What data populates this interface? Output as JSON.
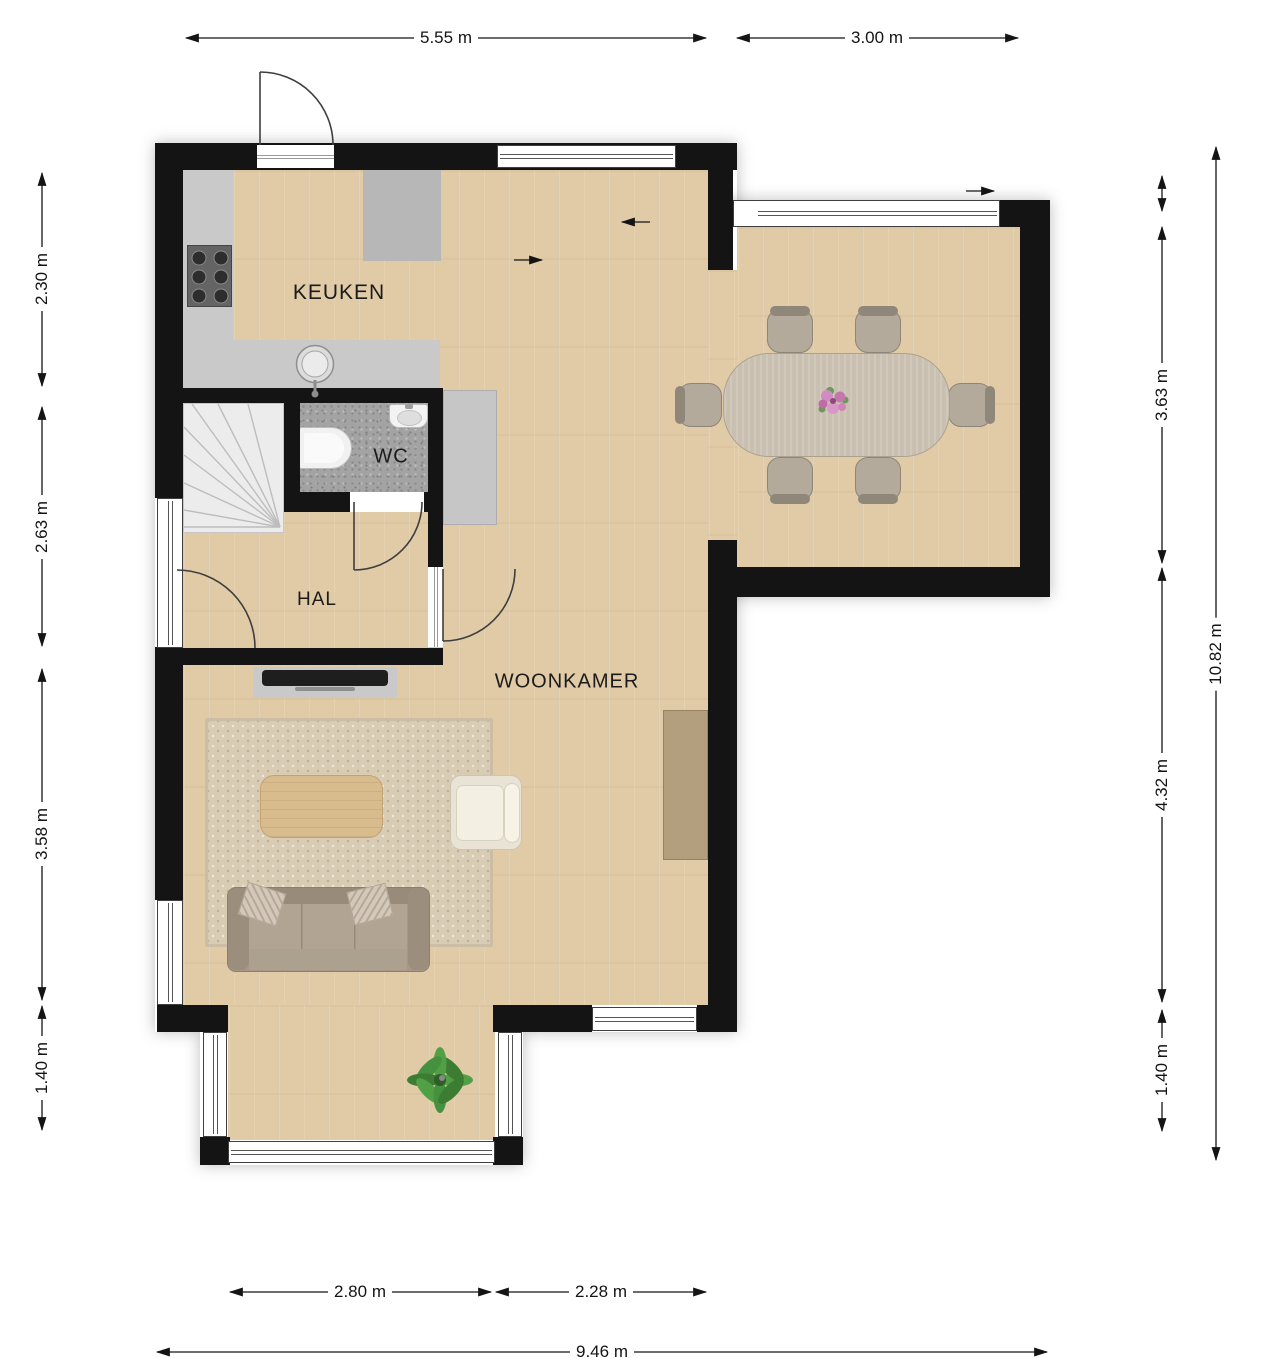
{
  "rooms": {
    "kitchen": {
      "label": "KEUKEN"
    },
    "wc": {
      "label": "WC"
    },
    "hall": {
      "label": "HAL"
    },
    "living": {
      "label": "WOONKAMER"
    }
  },
  "dimensions": {
    "top_kitchen": "5.55 m",
    "top_dining": "3.00 m",
    "left_kitchen": "2.30 m",
    "left_hall": "2.63 m",
    "left_living": "3.58 m",
    "left_bay": "1.40 m",
    "right_dining": "3.63 m",
    "right_living": "4.32 m",
    "right_bay": "1.40 m",
    "right_total": "10.82 m",
    "bottom_bay": "2.80 m",
    "bottom_living": "2.28 m",
    "bottom_total": "9.46 m"
  },
  "furniture": {
    "dining_table": "dining-table",
    "dining_chair_count": 6,
    "flowers": "flower-bouquet",
    "sofa": "three-seat-sofa",
    "sofa_pillow_count": 2,
    "rug": "area-rug",
    "coffee_table": "coffee-table",
    "armchair": "armchair",
    "tv": "tv-on-console",
    "sideboard": "sideboard",
    "plant": "potted-plant"
  },
  "fixtures": {
    "stove": "gas-hob",
    "stove_burner_count": 6,
    "sink": "kitchen-sink",
    "toilet": "wall-hung-toilet",
    "basin": "wash-basin",
    "stairs": "winder-staircase",
    "door_count": 4,
    "window_count": 9
  },
  "colors": {
    "wall": "#141414",
    "floor_wood": "#e0cba6",
    "wc_floor": "#a3a3a3",
    "counter": "#c9c9c9",
    "rug": "#d8ccb5",
    "sofa": "#a59887",
    "armchair": "#e9e3d5",
    "dining_table": "#c9c0b1",
    "chair": "#b3aa9c",
    "sideboard": "#b39e7d",
    "plant": "#4c9440",
    "flowers": "#cf8abd",
    "dimension_text": "#141414"
  }
}
